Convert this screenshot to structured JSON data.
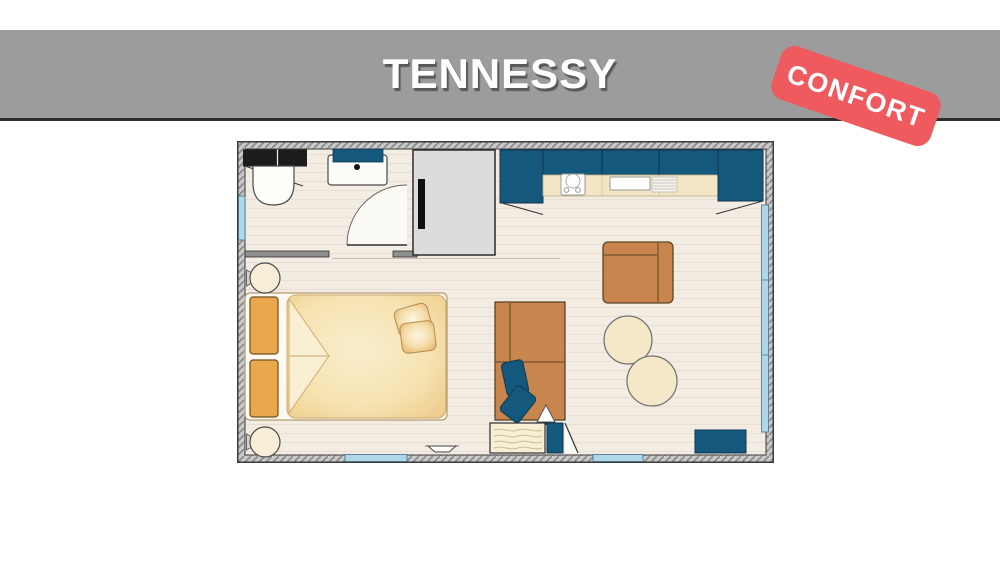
{
  "header": {
    "title": "TENNESSY",
    "badge": "CONFORT"
  },
  "palette": {
    "band_gray": "#9c9c9c",
    "band_edge": "#2e2e2e",
    "badge_red": "#ee5a5e",
    "cabinet_blue": "#14587d",
    "furniture_brown": "#c8854e",
    "furniture_brown_stroke": "#5d4426",
    "bed_white": "#fdf9f0",
    "duvet_cream": "#f6e3b2",
    "cushion_orange": "#e9a84c",
    "window_blue": "#aed8e8",
    "wall_gray": "#c9c9c9",
    "wall_hatch": "#8a8a8a",
    "floor_cream": "#f3ece3",
    "counter_cream": "#f2e6c4",
    "appliance_gray": "#dcdcda",
    "black_unit": "#1c1c1c"
  },
  "floor_plan": {
    "rooms": [
      "bathroom",
      "kitchen",
      "bedroom",
      "living-area"
    ],
    "furniture": [
      "bathroom-cabinet",
      "toilet",
      "washbasin",
      "bathroom-door",
      "wardrobe",
      "kitchen-corner-cabinet-left",
      "kitchen-cabinet-row",
      "kitchen-worktop",
      "hob",
      "kitchen-sink",
      "drainer",
      "kitchen-corner-cabinet-right",
      "double-bed",
      "headboard-cushion",
      "headboard-cushion",
      "pillow",
      "pillow",
      "reading-lamp",
      "reading-lamp",
      "sofa",
      "sofa-cushion",
      "sofa-cushion",
      "table-lamp",
      "side-chest",
      "entrance-door",
      "armchair",
      "round-table",
      "round-table",
      "storage-bench",
      "bay-window",
      "window",
      "window",
      "window",
      "doorstep"
    ]
  }
}
